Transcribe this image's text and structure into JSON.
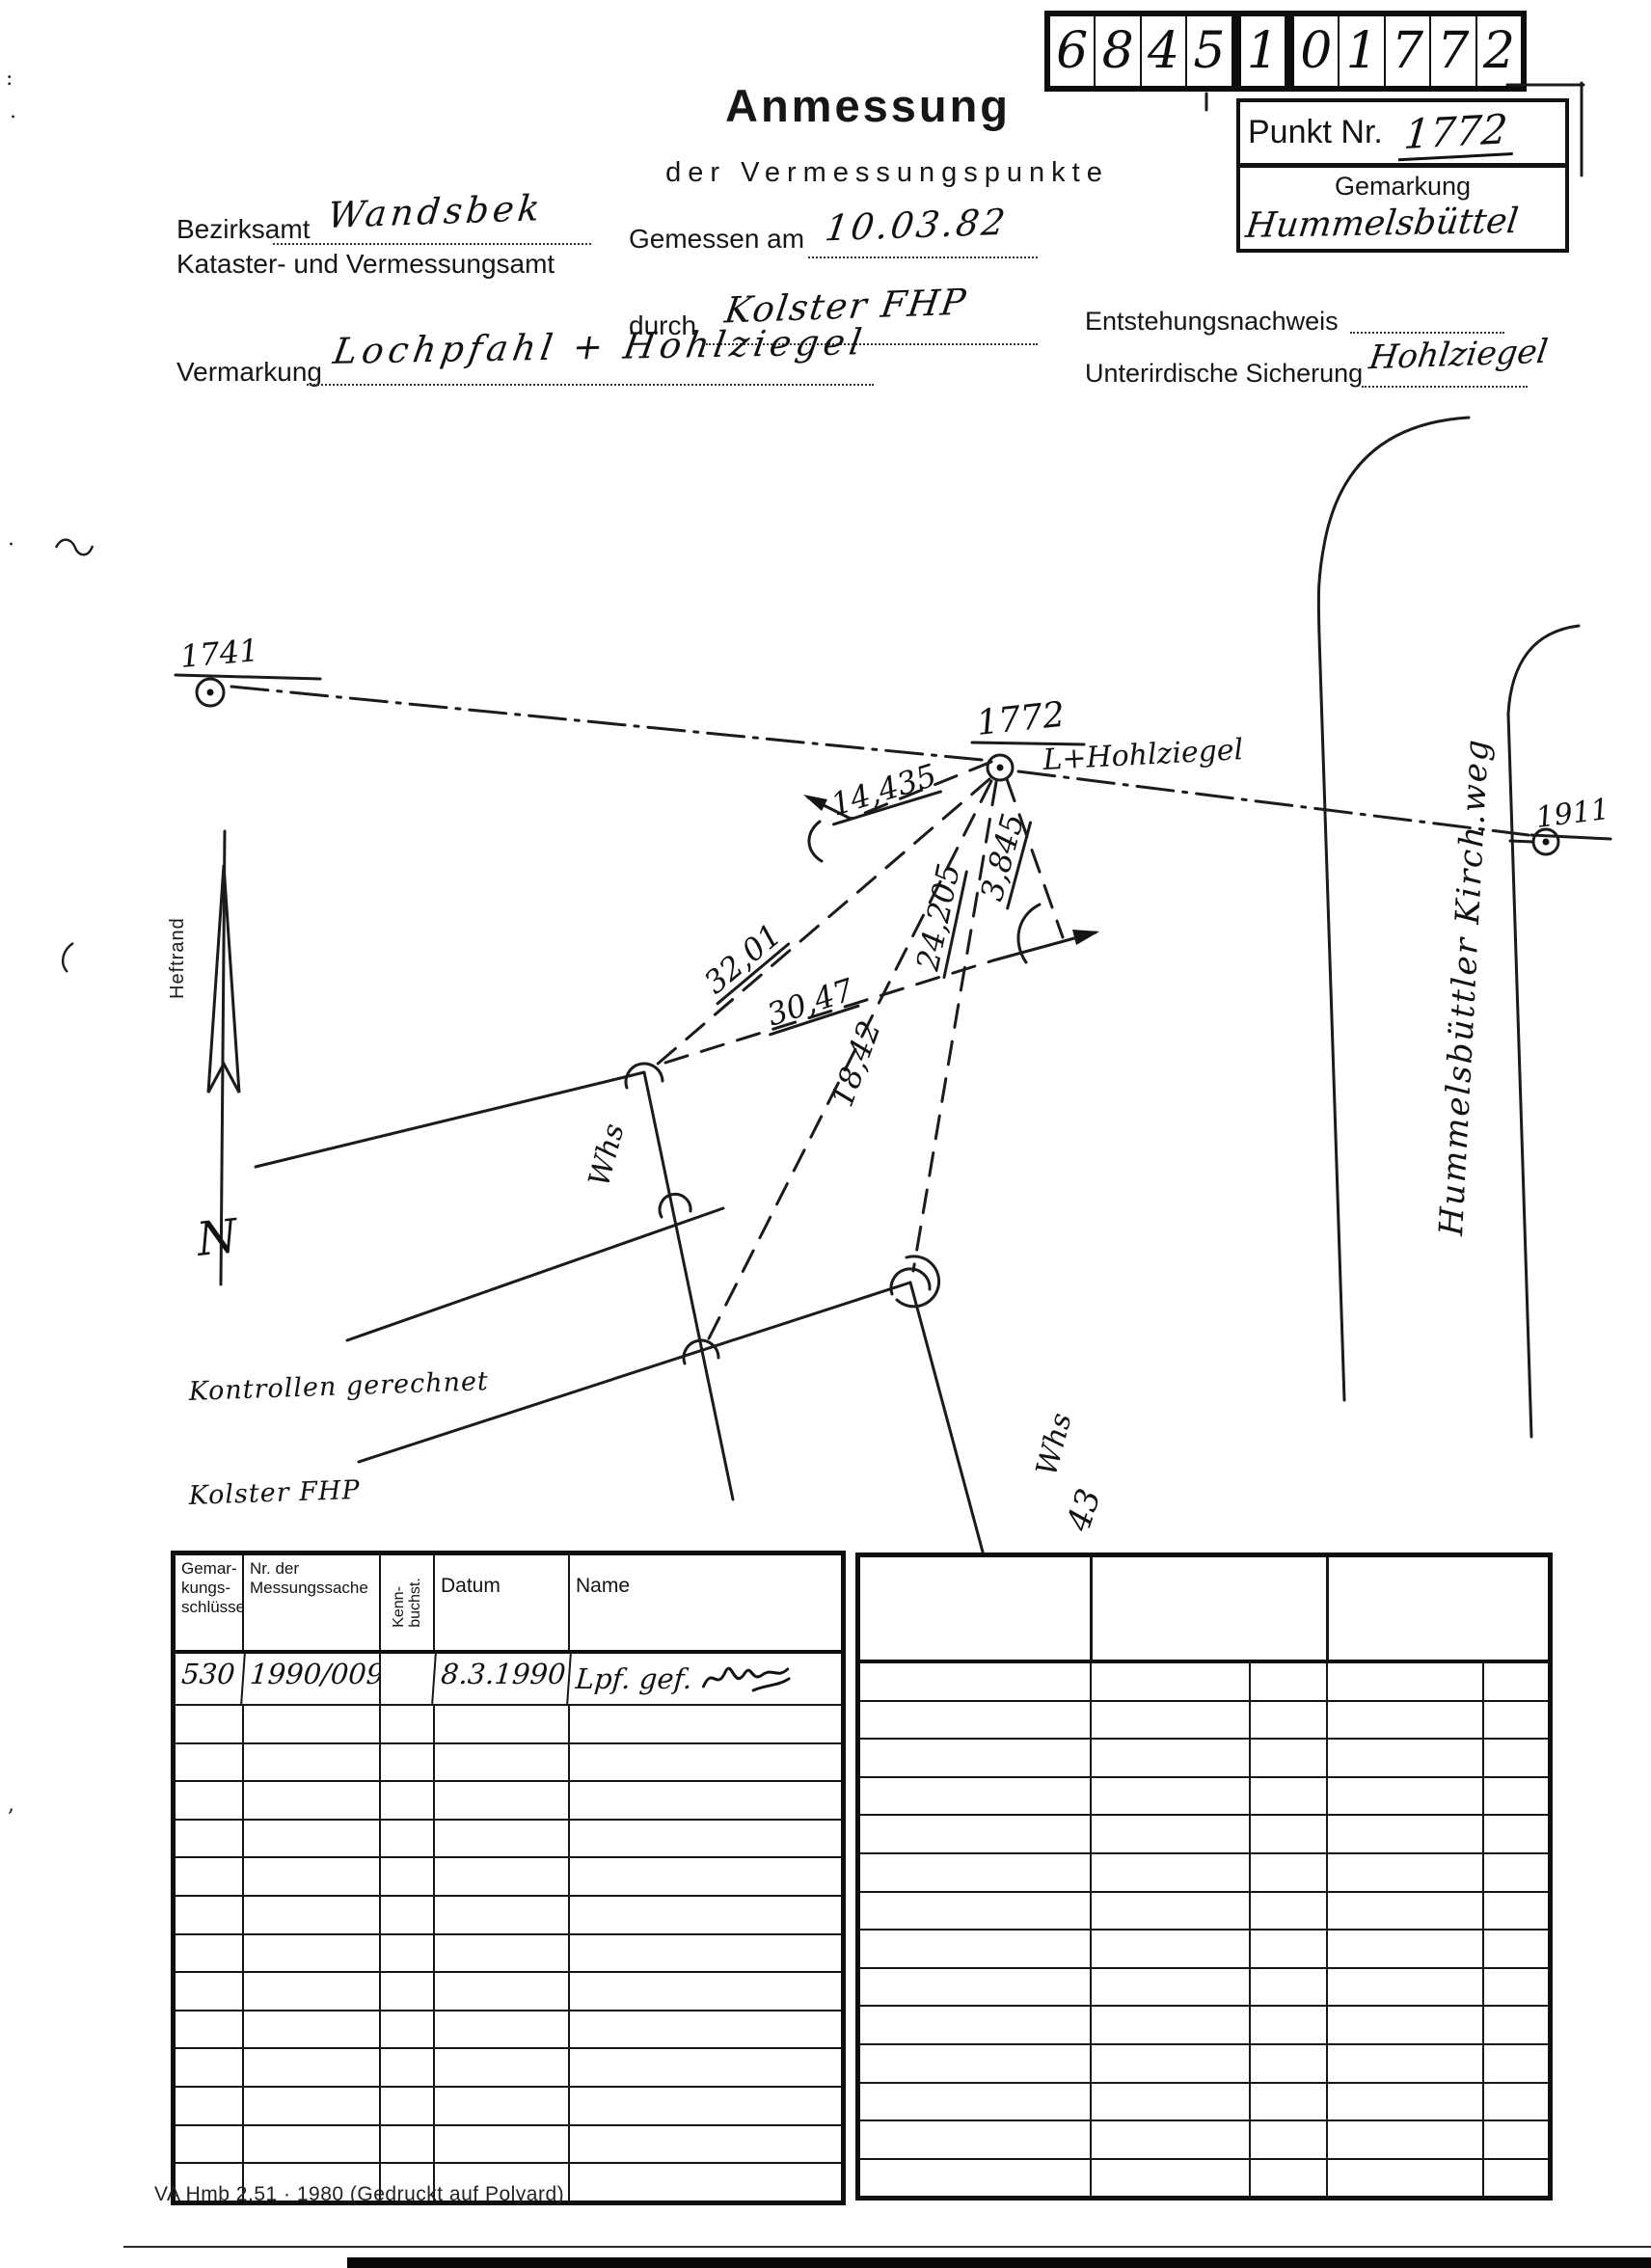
{
  "doc": {
    "code_box": {
      "digits": [
        "6",
        "8",
        "4",
        "5",
        "1",
        "0",
        "1",
        "7",
        "7",
        "2"
      ]
    },
    "header": {
      "title": "Anmessung",
      "subtitle": "der Vermessungspunkte",
      "punkt_label": "Punkt Nr.",
      "punkt_value": "1772",
      "gemarkung_label": "Gemarkung",
      "gemarkung_value": "Hummelsbüttel",
      "bezirksamt_label": "Bezirksamt",
      "bezirksamt_value": "Wandsbek",
      "kataster_label": "Kataster- und Vermessungsamt",
      "gemessen_label": "Gemessen am",
      "gemessen_value": "10.03.82",
      "durch_label": "durch",
      "durch_value": "Kolster FHP",
      "entstehung_label": "Entstehungsnachweis",
      "vermarkung_label": "Vermarkung",
      "vermarkung_value": "Lochpfahl + Hohlziegel",
      "sicherung_label": "Unterirdische Sicherung",
      "sicherung_value": "Hohlziegel"
    },
    "sketch": {
      "margin_label": "Heftrand",
      "north_label": "N",
      "point_1741": "1741",
      "point_1772": "1772",
      "point_1772_sub": "L+Hohlziegel",
      "point_1911": "1911",
      "dist_14435": "14,435",
      "dist_3201": "32,01",
      "dist_3047": "30,47",
      "dist_24205": "24,205",
      "dist_3845": "3,845",
      "dist_1842": "18,42",
      "whs_left": "Whs",
      "whs_right": "Whs",
      "house_no": "43",
      "street": "Hummelsbüttler Kirch.weg",
      "note_line1": "Kontrollen gerechnet",
      "note_line2": "Kolster FHP"
    },
    "log_table": {
      "headers": [
        "Gemar-\nkungs-\nschlüssel",
        "Nr. der\nMessungssache",
        "Kenn-\nbuchst.",
        "Datum",
        "Name"
      ],
      "row": {
        "schluessel": "530",
        "messungssache": "1990/009",
        "kennbuchst": "",
        "datum": "8.3.1990",
        "name": "Lpf. gef."
      },
      "empty_rows": 13
    },
    "right_table": {
      "empty_rows": 14
    },
    "footer": {
      "imprint": "VA Hmb 2.51 · 1980 (Gedruckt auf Polyard)"
    }
  }
}
